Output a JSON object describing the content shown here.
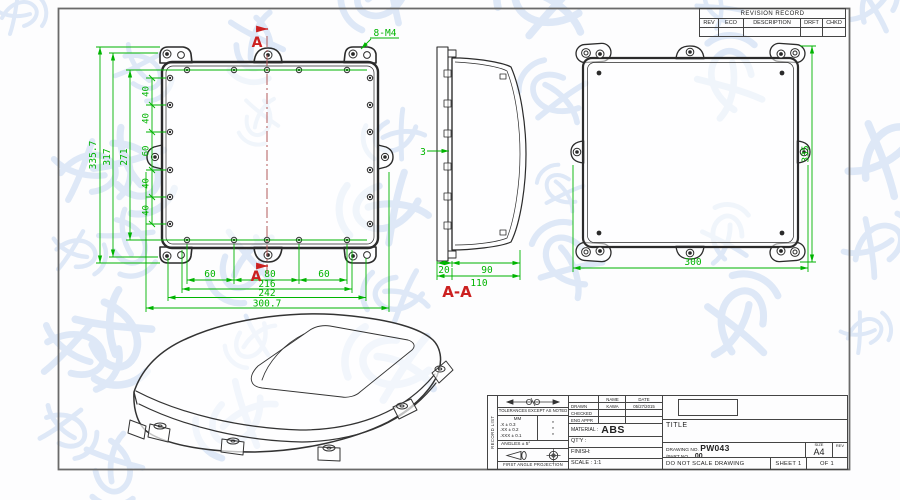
{
  "colors": {
    "dimension": "#00b400",
    "section_mark": "#cc2020",
    "line": "#2b2b2b",
    "watermark": "#c5d8f0"
  },
  "annotations": {
    "thread_callout": "8-M4",
    "section_letter_top": "A",
    "section_letter_bottom": "A",
    "section_view_title": "A-A",
    "wall_thickness": "3"
  },
  "front_view": {
    "overall_height": "335.7",
    "ear_hole_height": "317",
    "hole_rows_height": "271",
    "pitch_dims": [
      "40",
      "40",
      "60",
      "40",
      "40"
    ],
    "hole_span_dims": [
      "60",
      "80",
      "60"
    ],
    "width_dims": [
      "216",
      "242",
      "300.7"
    ]
  },
  "section_view": {
    "lid_depth": "20",
    "base_depth": "90",
    "total_depth": "110"
  },
  "back_view": {
    "height_dim": "335",
    "width_dim": "300"
  },
  "revision_table": {
    "title": "REVISION RECORD",
    "columns": [
      "REV",
      "ECO",
      "DESCRIPTION",
      "DRFT",
      "CHKD"
    ]
  },
  "title_block": {
    "side_strip": "RECORD LIST",
    "tolerances": {
      "heading": "TOLERANCES EXCEPT AS NOTED",
      "unit": "MM",
      "rows": [
        ".X ± 0.3",
        ".XX ± 0.2",
        ".XXX ± 0.1"
      ],
      "star": "*",
      "angles": "ANGLES ± 5°",
      "projection": "FIRST ANGLE PROJECTION"
    },
    "approvals": {
      "name_header": "NAME",
      "date_header": "DATE",
      "rows": [
        {
          "label": "DRAWN",
          "name": "KAWA",
          "date": "05/27/2015"
        },
        {
          "label": "CHECKED",
          "name": "",
          "date": ""
        },
        {
          "label": "ENG APPR",
          "name": "",
          "date": ""
        }
      ]
    },
    "material_label": "MATERIAL :",
    "material_value": "ABS",
    "qty_label": "QT'Y :",
    "finish_label": "FINISH:",
    "scale_label": "SCALE : 1:1",
    "title_label": "TITLE",
    "drawing_no_label": "DRAWING NO.",
    "drawing_no_value": "PW043",
    "part_no_label": "/PART NO.",
    "part_no_value": "00",
    "note": "DO NOT SCALE DRAWING",
    "sheet": "SHEET 1",
    "of": "OF 1",
    "size_label": "SIZE",
    "size_value": "A4",
    "rev_label": "REV"
  }
}
